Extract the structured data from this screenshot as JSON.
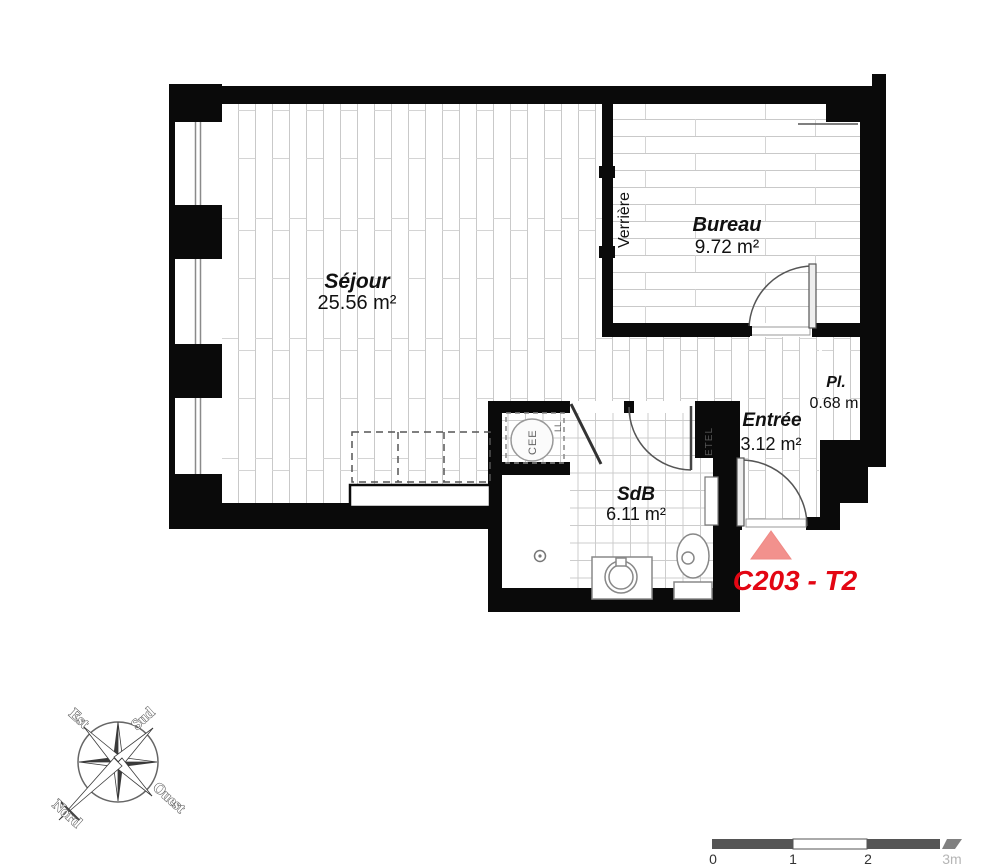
{
  "plan": {
    "unit_marker": {
      "label": "C203 - T2"
    },
    "rooms": [
      {
        "name": "Séjour",
        "area": "25.56 m²"
      },
      {
        "name": "Bureau",
        "area": "9.72 m²"
      },
      {
        "name": "SdB",
        "area": "6.11 m²"
      },
      {
        "name": "Entrée",
        "area": "3.12 m²"
      },
      {
        "name": "Pl.",
        "area": "0.68 m"
      }
    ],
    "annotations": {
      "verriere": "Verrière",
      "etel": "ETEL",
      "water_heater": "CEE",
      "washer": "LL"
    }
  },
  "compass": {
    "north": "Nord",
    "south": "Sud",
    "east": "Est",
    "west": "Ouest"
  },
  "scale_bar": {
    "ticks": [
      "0",
      "1",
      "2"
    ],
    "end_label": "3m"
  },
  "colors": {
    "wall": "#0a0a0a",
    "floor_line": "#c9c9c9",
    "marker_fill": "#f2918d",
    "unit_label": "#e30613"
  }
}
